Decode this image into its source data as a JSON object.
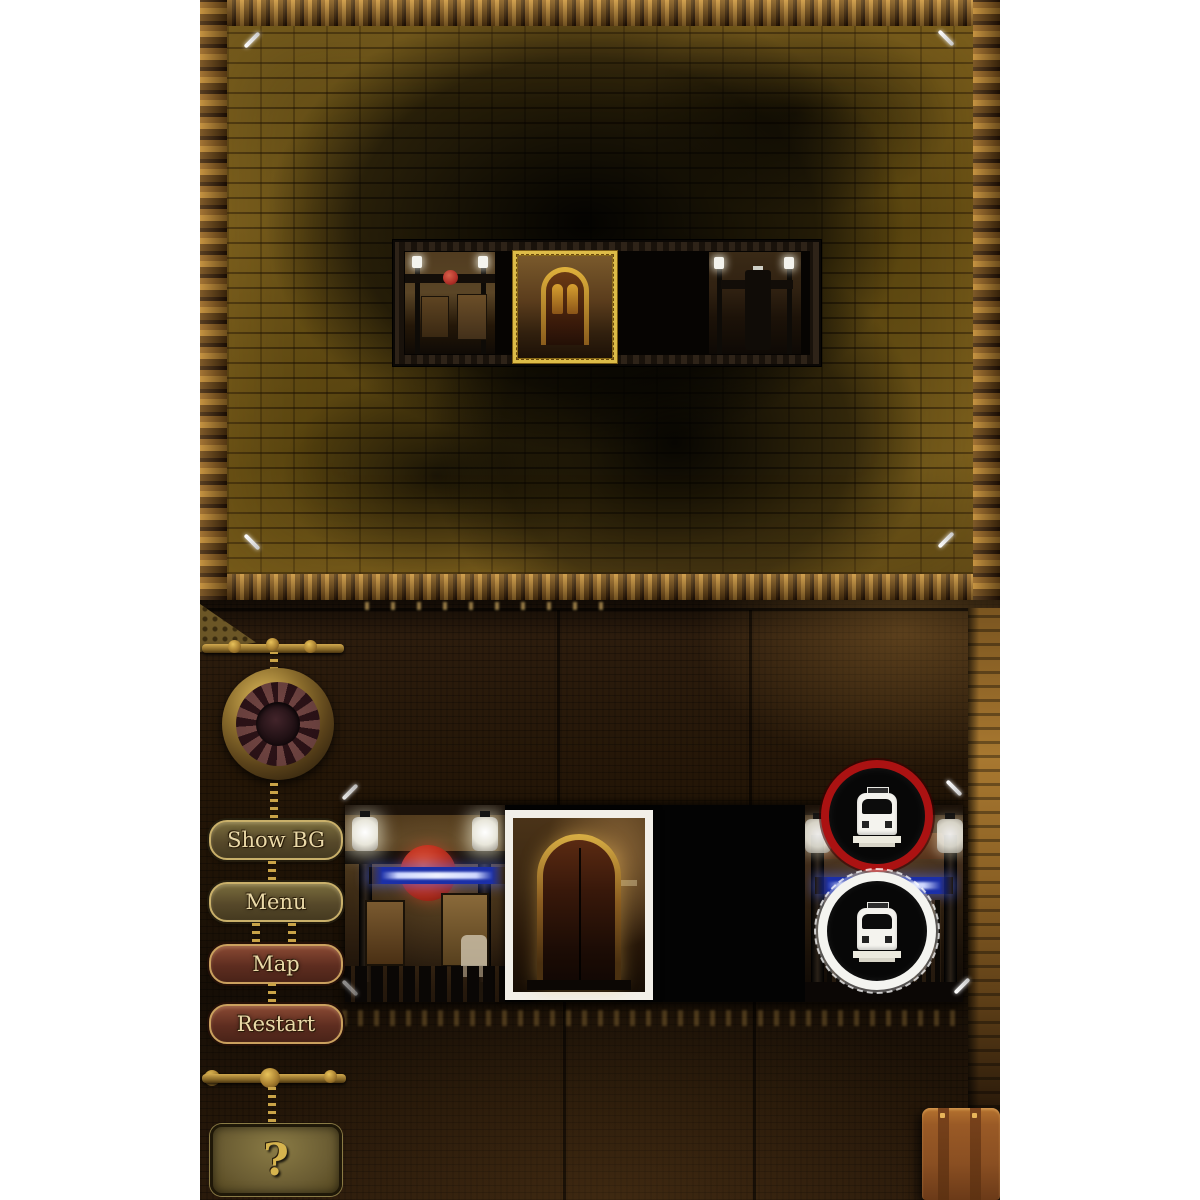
{
  "sidebar": {
    "buttons": [
      {
        "label": "Show BG",
        "variant": "olive"
      },
      {
        "label": "Menu",
        "variant": "olive"
      },
      {
        "label": "Map",
        "variant": "red"
      },
      {
        "label": "Restart",
        "variant": "red"
      }
    ],
    "help_button_label": "?"
  },
  "top_screen": {
    "minimap": {
      "cells": [
        "station-entrance-room",
        "current-room-door-highlighted",
        "empty-slot",
        "station-gate-room"
      ],
      "highlight_color": "#ddbc48"
    }
  },
  "bottom_screen": {
    "room_strip": {
      "pieces": [
        "station-entrance-room",
        "door-room-card",
        "empty-slot",
        "station-gate-room"
      ]
    },
    "badges": [
      {
        "icon": "train-icon",
        "ring_color": "#ab1212",
        "ring_style": "solid-red"
      },
      {
        "icon": "train-icon",
        "ring_color": "#f4f4f0",
        "ring_style": "scalloped-white"
      }
    ],
    "props": [
      "brass-medallion",
      "suitcase"
    ]
  },
  "colors": {
    "page_margin": "#ffffff",
    "wood_plank": "#b5812f",
    "brick_wall": "#5e4a16",
    "panel_wall": "#241607",
    "button_olive": "#57492a",
    "button_red": "#5e2d20",
    "button_border_gold": "#c9b06a",
    "button_text_cream": "#ead9a8",
    "roundel_red": "#c23420",
    "sign_blue": "#1b2fa8",
    "highlight_gold": "#ddbc48"
  }
}
